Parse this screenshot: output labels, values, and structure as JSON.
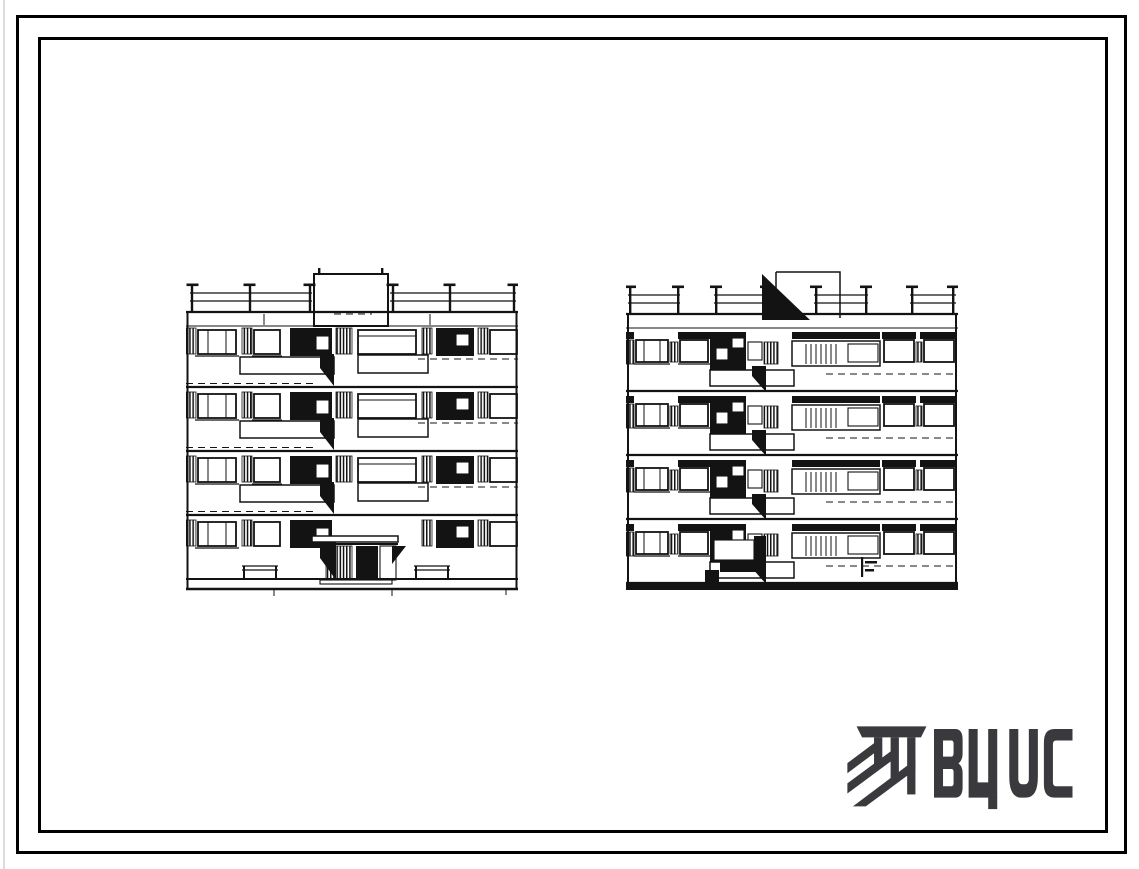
{
  "logo": {
    "text": "ВЦИС",
    "icon": "vcis-diagonal-stripes-mark-icon",
    "color": "#3a3a3e"
  },
  "colors": {
    "background": "#ffffff",
    "ink": "#131313",
    "frame": "#000000"
  }
}
